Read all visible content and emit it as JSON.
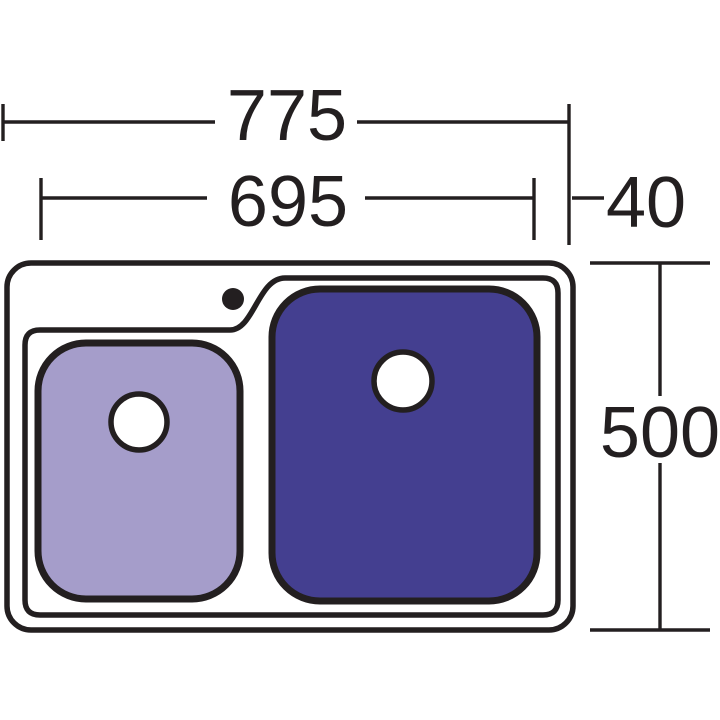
{
  "page": {
    "type": "technical-dimension-drawing",
    "subject": "double bowl kitchen sink, top view",
    "background": "#ffffff"
  },
  "colors": {
    "line": "#231f20",
    "sink_surface": "#ffffff",
    "small_bowl_fill": "#a59dca",
    "large_bowl_fill": "#443f90",
    "drain_fill": "#ffffff"
  },
  "dims": {
    "w775": {
      "label": "775",
      "value": 775,
      "meaning": "overall width"
    },
    "w695": {
      "label": "695",
      "value": 695,
      "meaning": "width to bowl edge"
    },
    "w40": {
      "label": "40",
      "value": 40,
      "meaning": "right inset"
    },
    "h500": {
      "label": "500",
      "value": 500,
      "meaning": "overall depth"
    }
  }
}
